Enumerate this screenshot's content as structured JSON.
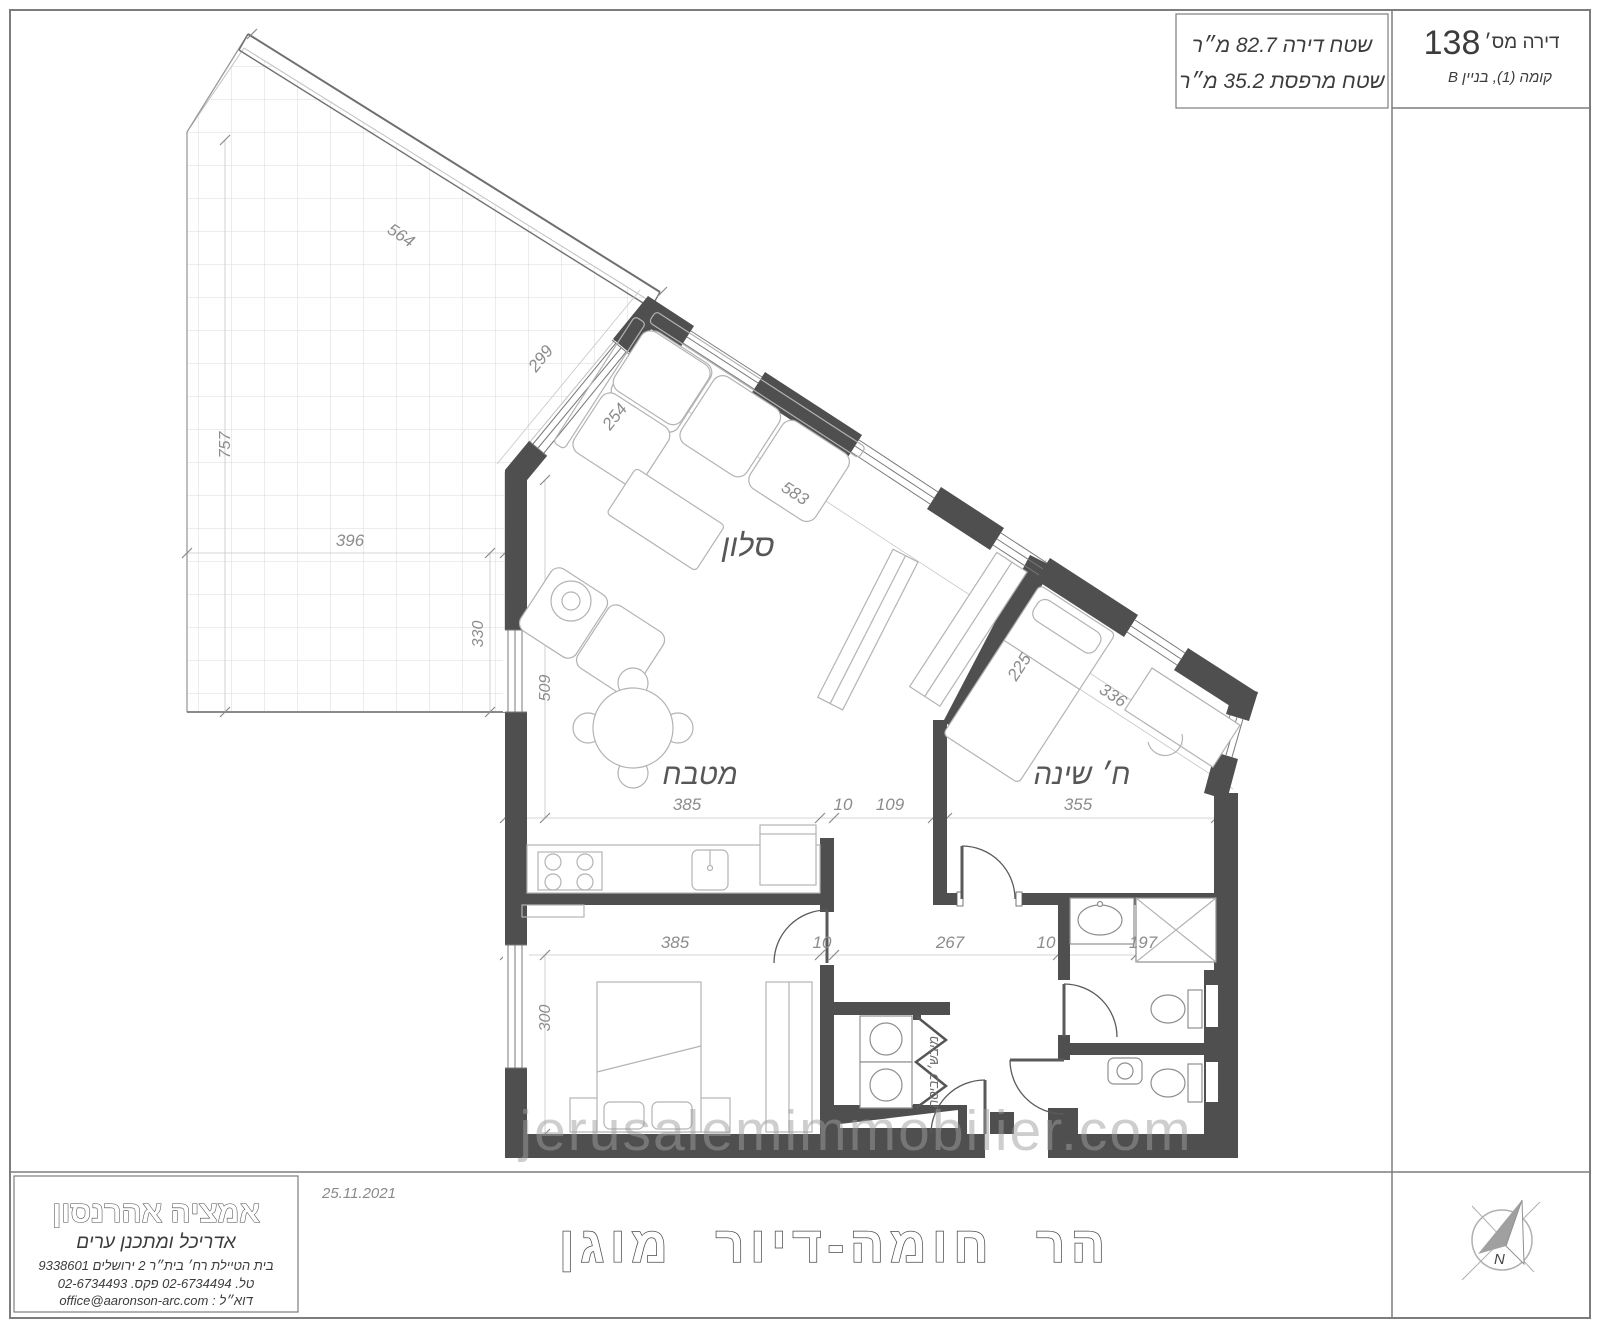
{
  "title_block": {
    "apartment_label": "דירה מס׳",
    "apartment_number": "138",
    "floor_line": "קומה (1), בניין B",
    "area_apartment": "שטח דירה  82.7 מ״ר",
    "area_balcony": "שטח מרפסת  35.2 מ״ר"
  },
  "rooms": {
    "living": "סלון",
    "kitchen": "מטבח",
    "bedroom": "ח׳ שינה",
    "laundry": "מיבש׳ כביסה"
  },
  "dims": {
    "d564": "564",
    "d299": "299",
    "d757": "757",
    "d396": "396",
    "d330": "330",
    "d254": "254",
    "d509": "509",
    "d583": "583",
    "d385_top": "385",
    "d10_top": "10",
    "d109": "109",
    "d355": "355",
    "d385_bottom": "385",
    "d10_bottom_left": "10",
    "d267": "267",
    "d10_bottom_right": "10",
    "d197": "197",
    "d300": "300",
    "d225": "225",
    "d336": "336"
  },
  "architect": {
    "name": "אמציה אהרנסון",
    "profession": "אדריכל ומתכנן ערים",
    "address": "בית הטיילת  רח׳ בית״ר  2  ירושלים  9338601",
    "phone_fax": "טל. 02-6734494  פקס. 02-6734493",
    "email_line": "דוא״ל  :  office@aaronson-arc.com"
  },
  "footer": {
    "date": "25.11.2021",
    "project_title": "הר חומה-דיור מוגן"
  },
  "watermark": "jerusalemimmobilier.com",
  "compass": {
    "north": "N"
  },
  "colors": {
    "wall": "#4f4f4f",
    "line": "#9a9a9a",
    "dim_text": "#8c8c8c",
    "label": "#575757"
  }
}
